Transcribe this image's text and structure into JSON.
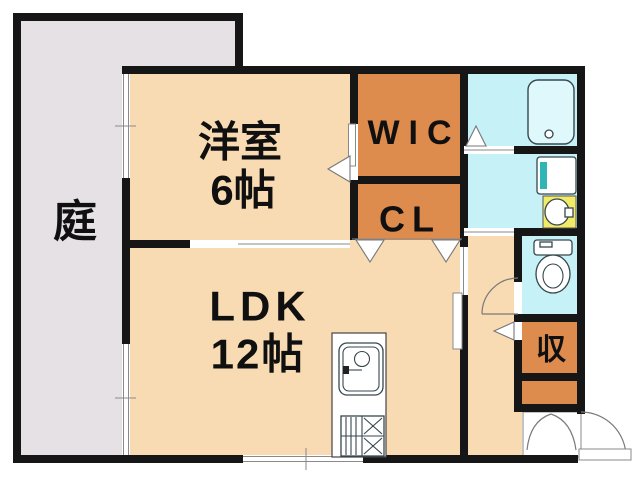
{
  "floorplan": {
    "rooms": {
      "garden": {
        "label": "庭"
      },
      "bedroom": {
        "label": "洋室",
        "size": "6帖"
      },
      "wic": {
        "label": "WIC"
      },
      "closet": {
        "label": "CL"
      },
      "ldk": {
        "label": "LDK",
        "size": "12帖"
      },
      "storage": {
        "label": "収"
      }
    },
    "colors": {
      "wall": "#161616",
      "room_floor": "#F8DBB2",
      "closet_fill": "#DE8B4E",
      "wet_area": "#C5F1F7",
      "garden": "#E5E1E5",
      "entrance": "#DBD7DA",
      "washbasin": "#F2EB67",
      "window_white": "#FFFFFF"
    },
    "fixtures": [
      "bathtub",
      "washing-machine-pan",
      "washbasin",
      "toilet",
      "kitchen-sink",
      "gas-stove",
      "entrance-door"
    ]
  }
}
